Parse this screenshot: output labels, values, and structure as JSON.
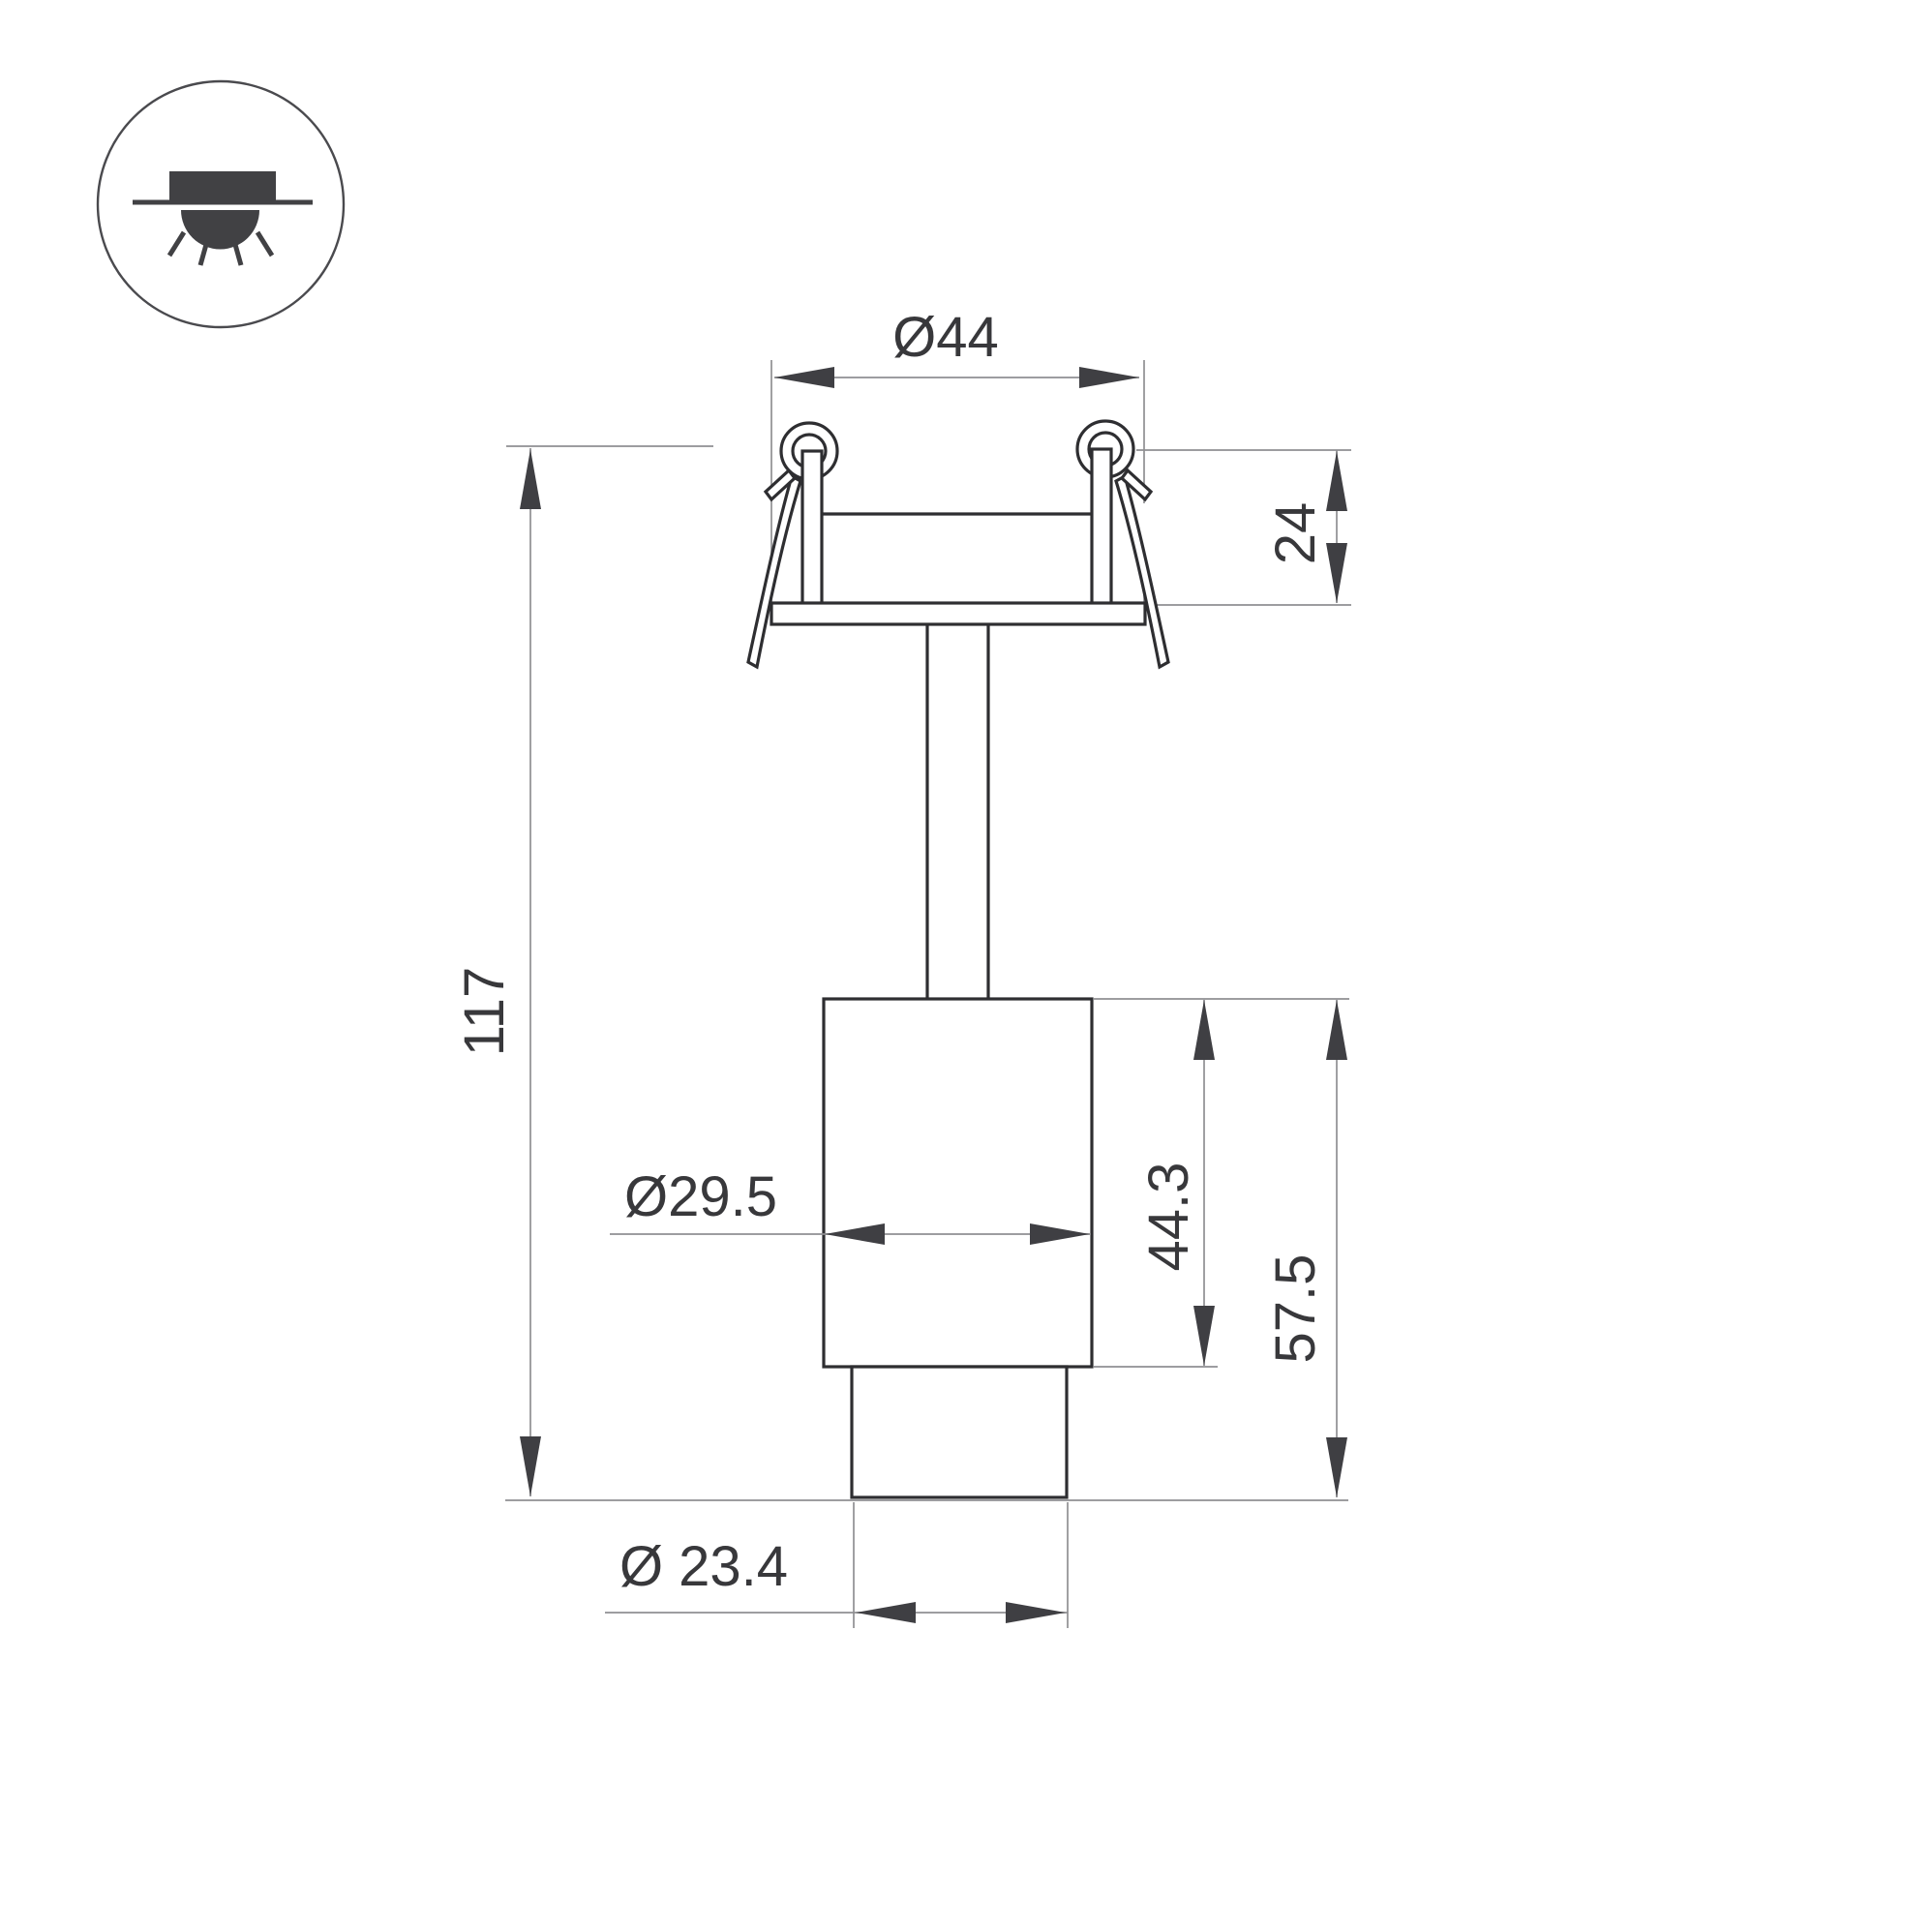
{
  "colors": {
    "background": "#ffffff",
    "outline": "#2e2e31",
    "thin_line": "#8f8f92",
    "arrow": "#3f3f43",
    "text": "#38383b",
    "icon": "#414144"
  },
  "icons": {
    "mount_type": "recessed-ceiling-downlight-icon"
  },
  "dimensions": {
    "flange_diameter": {
      "label": "Ø44",
      "value": 44
    },
    "recess_depth": {
      "label": "24",
      "value": 24
    },
    "overall_height": {
      "label": "117",
      "value": 117
    },
    "body_diameter": {
      "label": "Ø29.5",
      "value": 29.5
    },
    "body_height": {
      "label": "44.3",
      "value": 44.3
    },
    "body_lens_height": {
      "label": "57.5",
      "value": 57.5
    },
    "lens_diameter": {
      "label": "Ø 23.4",
      "value": 23.4
    }
  }
}
